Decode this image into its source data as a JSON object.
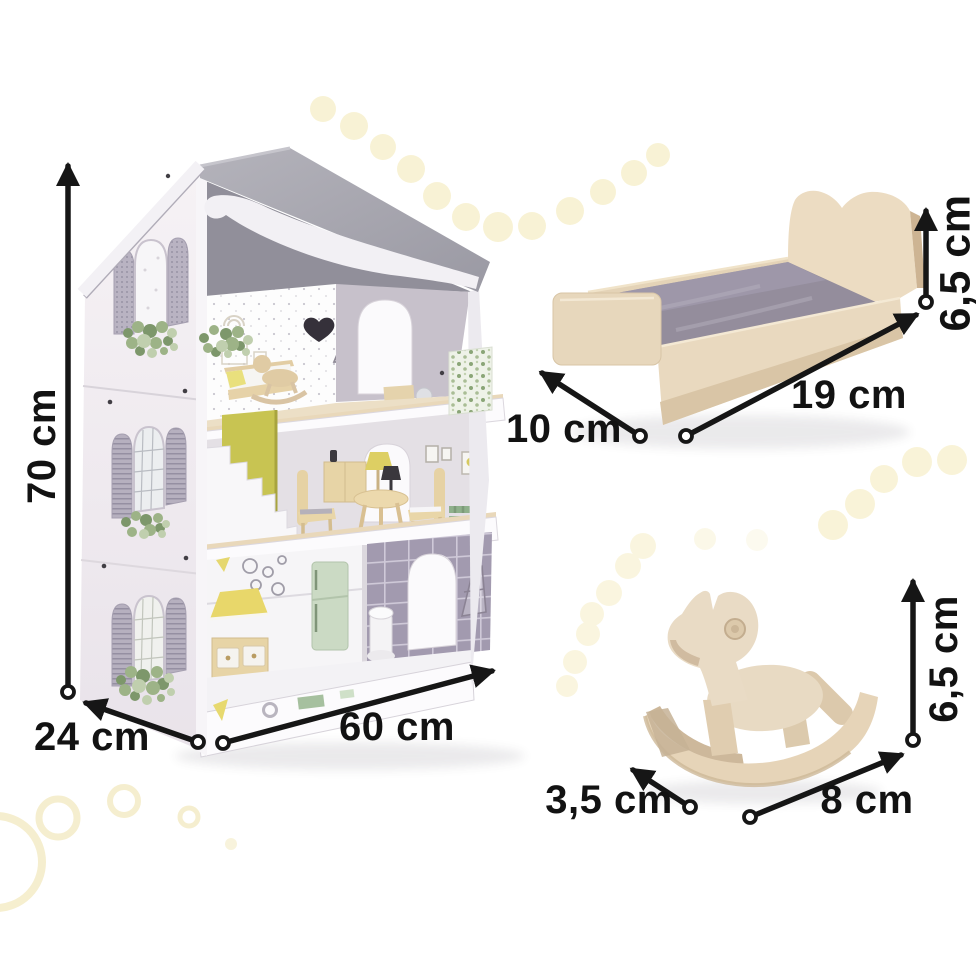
{
  "dimension_labels": {
    "dollhouse": {
      "height": "70 cm",
      "depth": "24 cm",
      "width": "60 cm"
    },
    "doll_bed": {
      "height": "6,5 cm",
      "length": "19 cm",
      "width": "10 cm"
    },
    "rocking_horse": {
      "height": "6,5 cm",
      "length": "8 cm",
      "width": "3,5 cm"
    }
  },
  "colors": {
    "dimension_text": "#121212",
    "arrow": "#161616",
    "roof_gray": "#a5a4ad",
    "wall_white": "#f3eff3",
    "stair_wall_chartreuse": "#c8c452",
    "wood_light": "#e9dac1",
    "mattress_gray": "#948d9c",
    "fridge_mint": "#cbdac4",
    "tile_purple": "#a29aaf",
    "hood_yellow": "#e8d76a",
    "bench_green": "#8fb08b",
    "decor_dot_yellow": "#f6efc9"
  }
}
